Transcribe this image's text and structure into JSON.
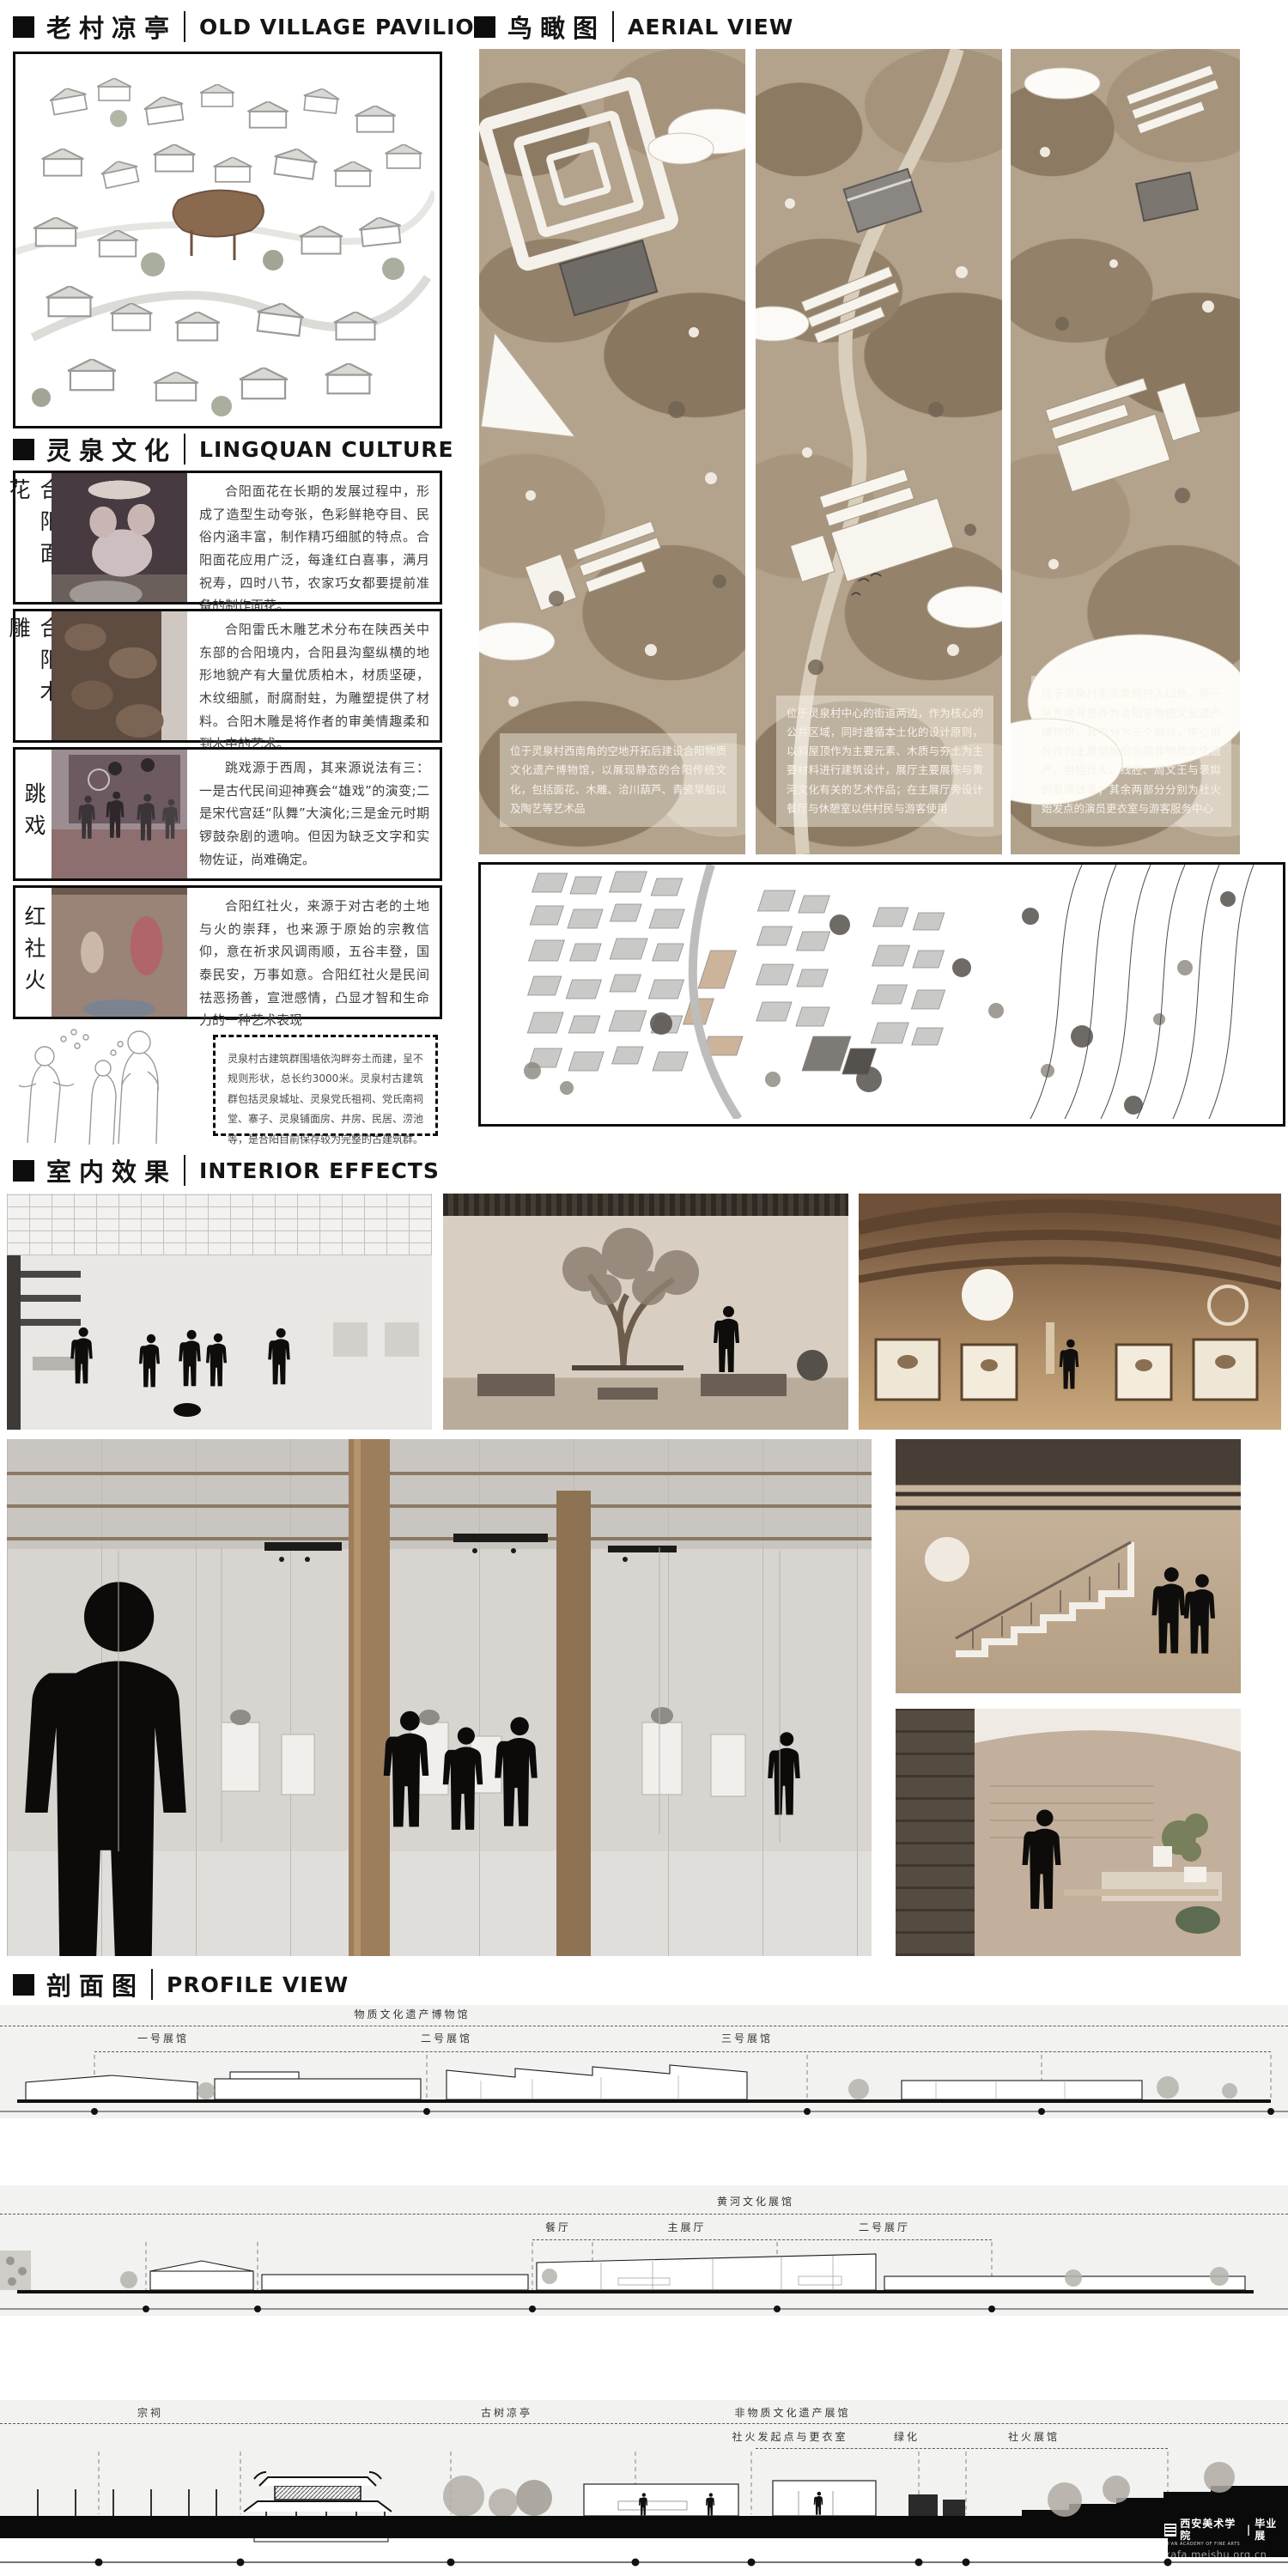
{
  "headers": {
    "pavilion": {
      "zh": "老村凉亭",
      "en": "OLD VILLAGE PAVILION"
    },
    "aerial": {
      "zh": "鸟瞰图",
      "en": "AERIAL VIEW"
    },
    "culture": {
      "zh": "灵泉文化",
      "en": "LINGQUAN CULTURE"
    },
    "interior": {
      "zh": "室内效果",
      "en": "INTERIOR EFFECTS"
    },
    "profile": {
      "zh": "剖面图",
      "en": "PROFILE VIEW"
    }
  },
  "culture_items": [
    {
      "label": "合阳面花",
      "text": "合阳面花在长期的发展过程中，形成了造型生动夸张，色彩鲜艳夺目、民俗内涵丰富，制作精巧细腻的特点。合阳面花应用广泛，每逢红白喜事，满月祝寿，四时八节，农家巧女都要提前准备的制作面花。"
    },
    {
      "label": "合阳木雕",
      "text": "合阳雷氏木雕艺术分布在陕西关中东部的合阳境内，合阳县沟壑纵横的地形地貌产有大量优质柏木，材质坚硬，木纹细腻，耐腐耐蛀，为雕塑提供了材料。合阳木雕是将作者的审美情趣柔和到木中的艺术。"
    },
    {
      "label": "跳戏",
      "text": "跳戏源于西周，其来源说法有三：一是古代民间迎神赛会“雄戏”的演变;二是宋代宫廷“队舞”大演化;三是金元时期锣鼓杂剧的遗响。但因为缺乏文字和实物佐证，尚难确定。"
    },
    {
      "label": "红社火",
      "text": "合阳红社火，来源于对古老的土地与火的崇拜，也来源于原始的宗教信仰，意在祈求风调雨顺，五谷丰登，国泰民安，万事如意。合阳红社火是民间祛恶扬善，宣泄感情，凸显才智和生命力的一种艺术表现"
    }
  ],
  "heritage_note": "灵泉村古建筑群围墙依沟畔夯土而建，呈不规则形状，总长约3000米。灵泉村古建筑群包括灵泉城址、灵泉党氏祖祠、党氏南祠堂、寨子、灵泉铺面房、井房、民居、涝池等，是合阳目前保存较为完整的古建筑群。",
  "aerial_captions": [
    "位于灵泉村西南角的空地开拓后建设合阳物质文化遗产博物馆，以展现静态的合阳传统文化，包括面花、木雕、洽川葫芦、青瓷旱船以及陶艺等艺术品",
    "位于灵泉村中心的街道两边，作为核心的公共区域，同时遵循本土化的设计原则，以斜屋顶作为主要元素、木质与夯土为主要材料进行建筑设计，展厅主要展陈与黄河文化有关的艺术作品；在主展厅旁设计餐厅与休憩室以供村民与游客使用",
    "位于灵泉村东南角的村入口处，将一块荒地开垦作为合阳非物质文化遗产博物馆，其中分为三个部分，中心部分作为主展馆展出合阳非物质文化遗产，包括社火、线腔、周文王与褒姒的爱情故事；其余两部分分别为社火始发点的演员更衣室与游客服务中心"
  ],
  "profile_sections": {
    "s1": {
      "group": "物质文化遗产博物馆",
      "r1": "一号展馆",
      "r2": "二号展馆",
      "r3": "三号展馆"
    },
    "s2": {
      "group": "黄河文化展馆",
      "r1": "餐厅",
      "r2": "主展厅",
      "r3": "二号展厅"
    },
    "s3": {
      "t1": "宗祠",
      "t2": "古树凉亭",
      "group": "非物质文化遗产展馆",
      "r1": "社火发起点与更衣室",
      "r2": "绿化",
      "r3": "社火展馆"
    }
  },
  "watermark": {
    "school": "西安美术学院",
    "divider": "|",
    "show": "毕业展",
    "sub": "XI'AN ACADEMY OF FINE ARTS",
    "url": "xafa.meishu.org.cn"
  },
  "colors": {
    "ink": "#111111",
    "terrain_base": "#b3a28c",
    "terrain_dark": "#8f7c64",
    "terrain_light": "#cfc3ae",
    "wood": "#9c7e5d",
    "paper": "#ffffff"
  }
}
